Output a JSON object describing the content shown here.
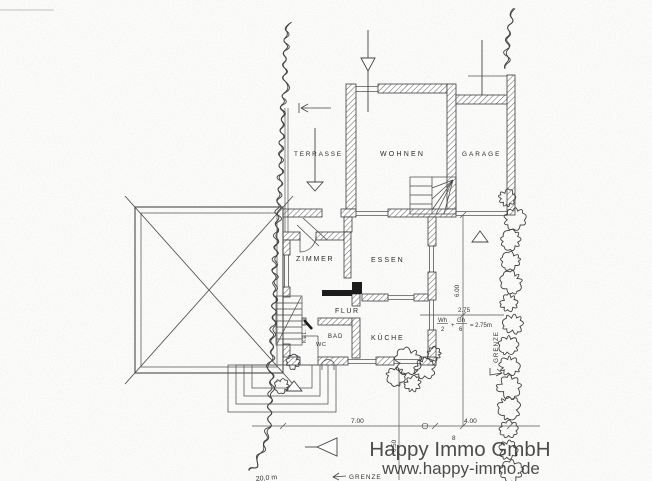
{
  "plan": {
    "rooms": {
      "terrasse": "TERRASSE",
      "wohnen": "WOHNEN",
      "garage": "GARAGE",
      "zimmer": "ZIMMER",
      "essen": "ESSEN",
      "flur": "FLUR",
      "bad": "BAD",
      "wc": "WC",
      "kueche": "KÜCHE",
      "keller_stairs": "KEL."
    },
    "dimensions": {
      "width_left": "7.00",
      "width_right": "4.00",
      "depth_right": "6.00",
      "offset_vertical": "6.50",
      "setback": "2.75",
      "point_label": "8",
      "cutoff_label": "20,0 m",
      "formula": {
        "num1": "Wh",
        "den1": "2",
        "plus": "+",
        "num2": "Gh",
        "den2": "6",
        "result": "= 2.75m"
      }
    },
    "boundary": {
      "right_label": "GRENZE",
      "bottom_label": "GRENZE"
    },
    "ink_color": "#3c3c3c"
  },
  "watermark": {
    "line1": "Happy Immo GmbH",
    "line2": "www.happy-immo.de",
    "color": "#8f8f8f"
  }
}
